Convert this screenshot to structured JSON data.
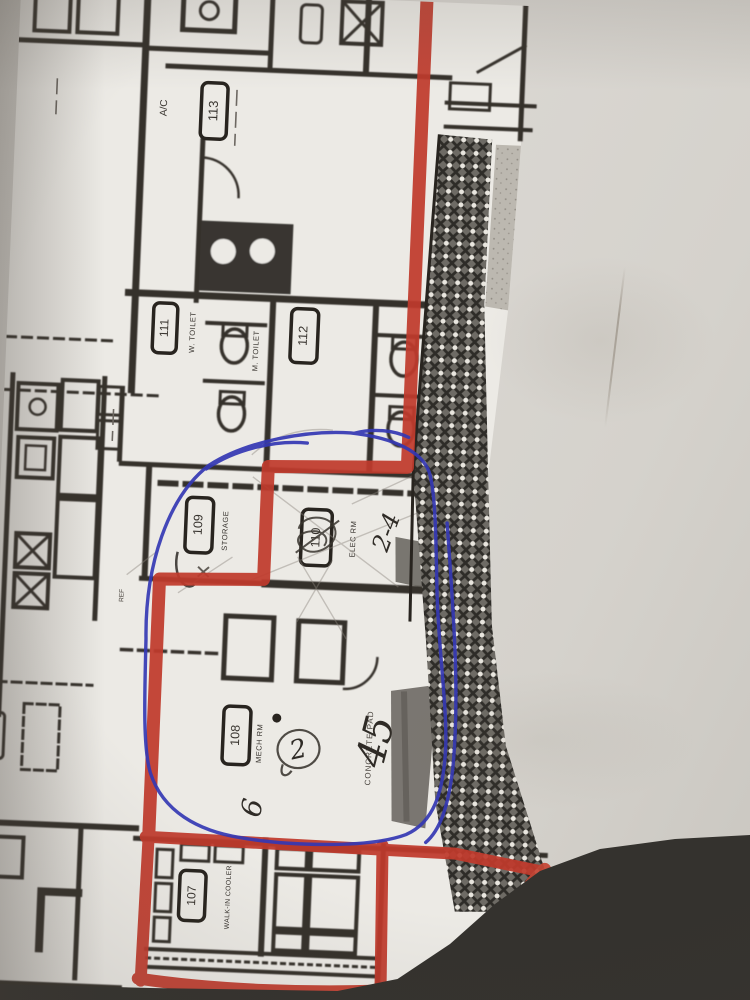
{
  "photo_of": "floor plan drawing with marker and pen annotations",
  "plan": {
    "rooms": [
      {
        "number": "113",
        "name": ""
      },
      {
        "number": "111",
        "name": "W. TOILET"
      },
      {
        "number": "112",
        "name": "M. TOILET"
      },
      {
        "number": "109",
        "name": "STORAGE"
      },
      {
        "number": "110",
        "name": "ELEC RM"
      },
      {
        "number": "108",
        "name": "MECH RM"
      },
      {
        "number": "107",
        "name": "WALK-IN COOLER"
      }
    ],
    "labels": {
      "ac": "A/C",
      "concrete_pad": "CONCRETE PAD",
      "conc_walk": "CONC WALK",
      "ref": "REF"
    }
  },
  "annotations": {
    "handwritten": [
      {
        "text": "2-4"
      },
      {
        "text": "2"
      },
      {
        "text": "45"
      },
      {
        "text": "6"
      }
    ]
  },
  "colors": {
    "red_marker": "#c03a2c",
    "blue_pen": "#3438b4",
    "ink": "#28241f",
    "paper": "#d6d3cd",
    "plan_paper": "#eceae5"
  }
}
